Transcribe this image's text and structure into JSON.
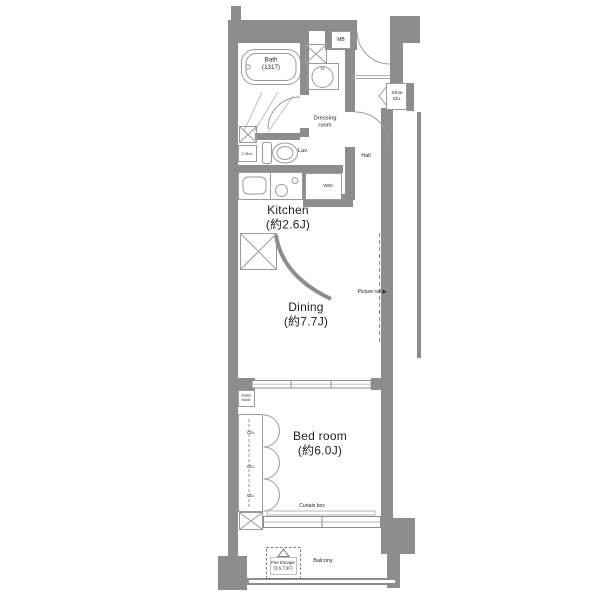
{
  "plan_title": "apartment floor plan",
  "colors": {
    "wall": "#8d8d8d",
    "line": "#9a9a9a",
    "text": "#1e1e1e",
    "background": "#ffffff"
  },
  "rooms": {
    "bath": {
      "name": "Bath",
      "size": "(1317)"
    },
    "dressing_room": {
      "line1": "Dressing",
      "line2": "room"
    },
    "hall": {
      "name": "Hall"
    },
    "kitchen": {
      "name": "Kitchen",
      "size": "(約2.6J)"
    },
    "dining": {
      "name": "Dining",
      "size": "(約7.7J)"
    },
    "bedroom": {
      "name": "Bed room",
      "size": "(約6.0J)"
    },
    "balcony": {
      "name": "Balcony"
    }
  },
  "labels": {
    "mb": "MB",
    "shoe_closet": {
      "line1": "Shoe",
      "line2": "Clo."
    },
    "lavatory": "Lav.",
    "c_box": "C.Box",
    "washer_dryer": "W/D",
    "closet": "Clo.",
    "glass_block": {
      "line1": "Glass",
      "line2": "block"
    },
    "picture_rail": "Picture rail",
    "picture_rail_arrow": "▶",
    "curtain_box": "Curtain box",
    "fire_escape": {
      "line1": "Fire Escape",
      "line2": "(3,6,7,9F)"
    }
  }
}
